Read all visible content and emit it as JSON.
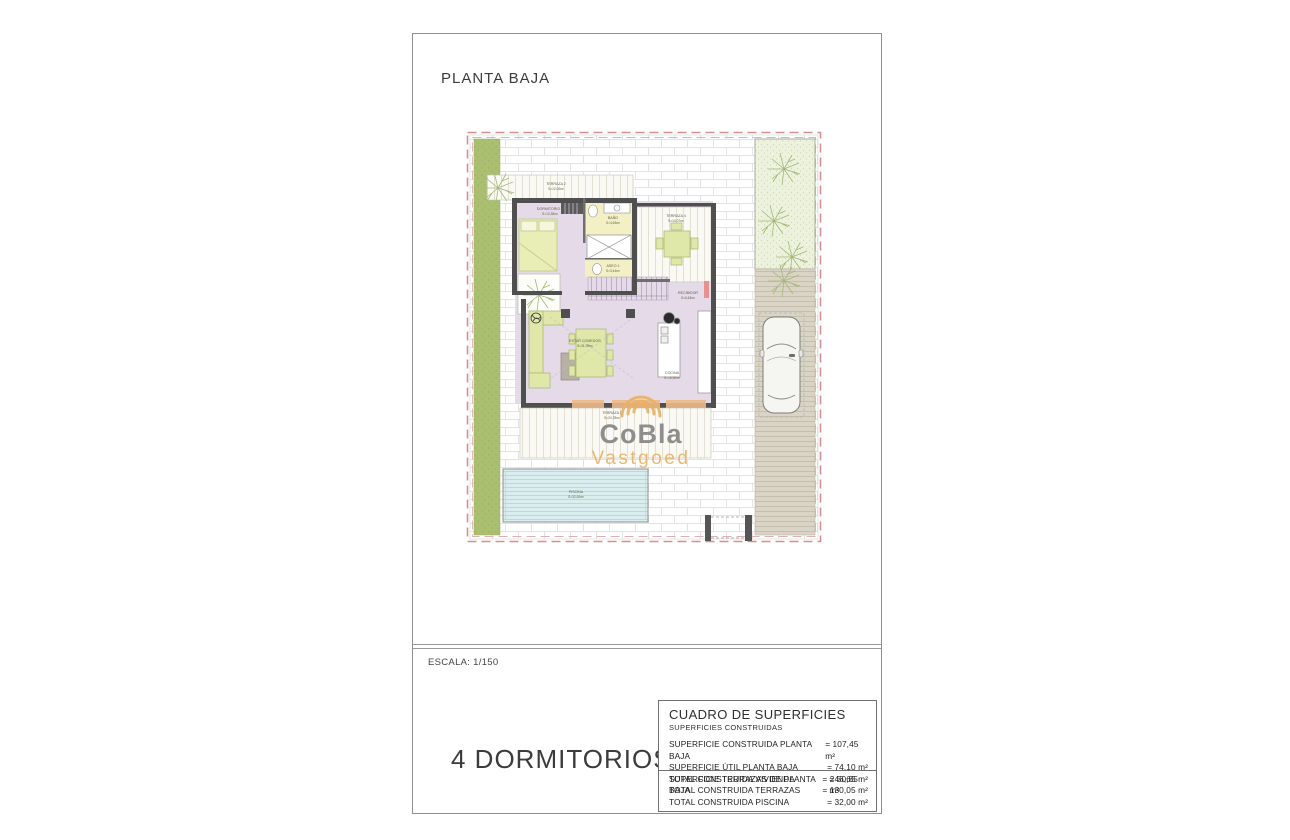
{
  "page": {
    "title": "PLANTA BAJA",
    "scale_label": "ESCALA: 1/150",
    "bedrooms_label": "4 DORMITORIOS"
  },
  "plan": {
    "rooms": {
      "terraza2": {
        "name": "TERRAZA 2",
        "area": "S=12,00m²"
      },
      "dormitorio1": {
        "name": "DORMITORIO 1",
        "area": "S=13,35m²"
      },
      "bano": {
        "name": "BAÑO",
        "area": "S=4,63m²"
      },
      "terraza4": {
        "name": "TERRAZA 4",
        "area": "S=14,07m²"
      },
      "aseo1": {
        "name": "ASEO 1",
        "area": "S=3,44m²"
      },
      "recibidor": {
        "name": "RECIBIDOR",
        "area": "S=6,63m²"
      },
      "estar_comedor": {
        "name": "ESTAR COMEDOR",
        "area": "S=31,09m²"
      },
      "cocina": {
        "name": "COCINA",
        "area": "S=16,50m²"
      },
      "terraza1": {
        "name": "TERRAZA 1",
        "area": "S=24,78m²"
      },
      "piscina": {
        "name": "PISCINA",
        "area": "S=32,00m²"
      }
    },
    "watermark": {
      "line1": "CoBla",
      "line2": "Vastgoed"
    }
  },
  "surface_table": {
    "title": "CUADRO DE SUPERFICIES",
    "subtitle": "SUPERFICIES CONSTRUIDAS",
    "rows": [
      {
        "label": "SUPERFICIE CONSTRUIDA PLANTA BAJA",
        "value": "= 107,45 m²"
      },
      {
        "label": "SUPERFICIE ÚTIL PLANTA BAJA",
        "value": "= 74,10 m²"
      },
      {
        "label": "SUPERFICIE TERRAZAS DE PLANTA BAJA",
        "value": "= 50,85 m²"
      }
    ],
    "totals": [
      {
        "label": "TOTAL CONSTRUIDA VIVIENDA",
        "value": "= 246,65 m²"
      },
      {
        "label": "TOTAL CONSTRUIDA TERRAZAS",
        "value": "= 130,05 m²"
      },
      {
        "label": "TOTAL CONSTRUIDA PISCINA",
        "value": "= 32,00 m²"
      }
    ]
  },
  "colors": {
    "plot_boundary_dashed": "#d49090",
    "grass": "#abbf70",
    "floor_lilac": "#e5dbe8",
    "wet_room_yellow": "#f3f0c6",
    "furniture_green": "#dfe8a8",
    "pool_blue": "#daeef0",
    "driveway_tan": "#d9d4c5",
    "pergola_orange": "#ecb987",
    "wall_gray": "#4f4f4f",
    "watermark_gray": "#868686",
    "watermark_orange": "#e9b268"
  }
}
